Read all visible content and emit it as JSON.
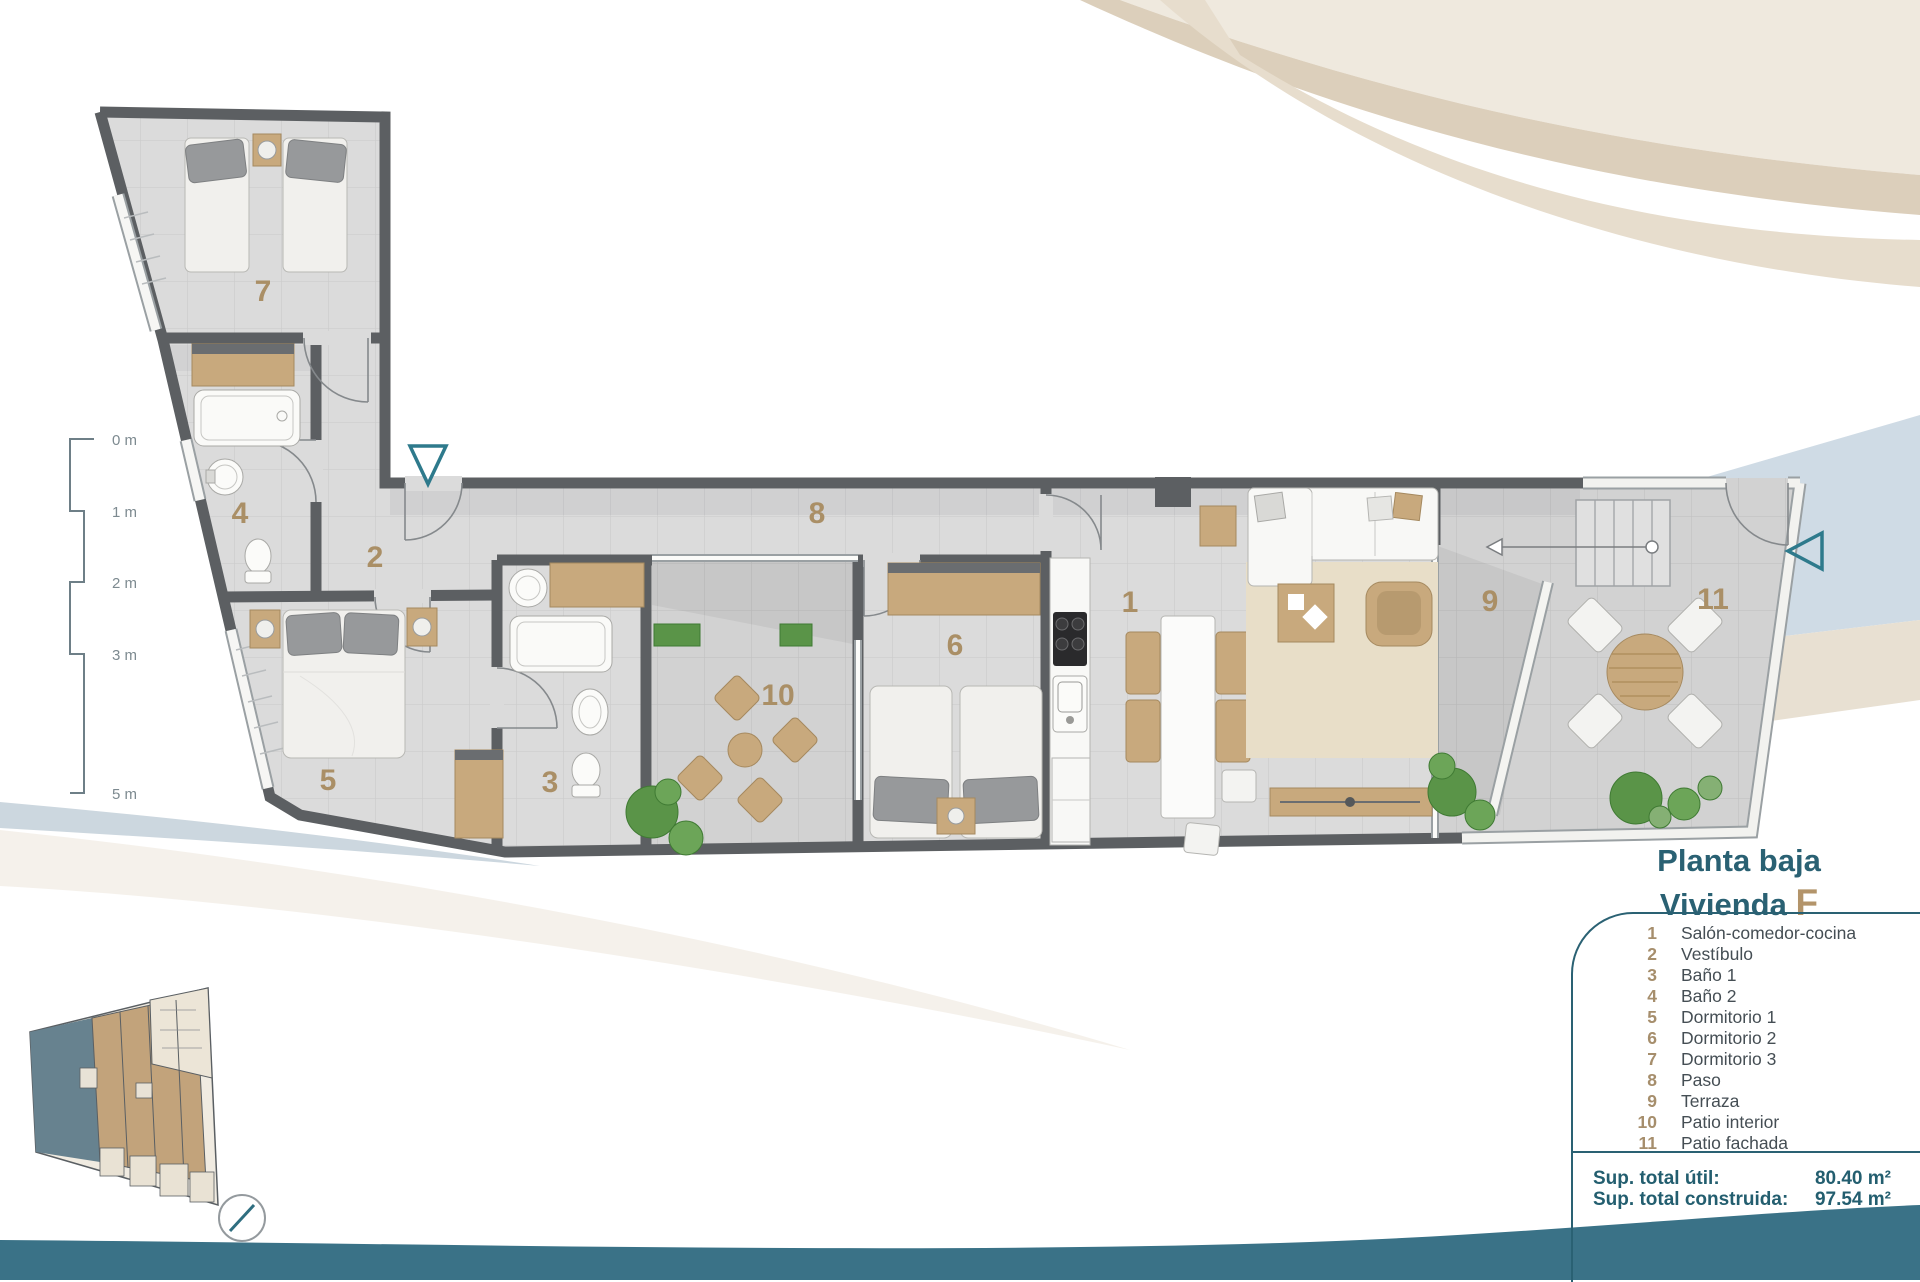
{
  "title": {
    "floor": "Planta baja",
    "dwelling_prefix": "Vivienda",
    "dwelling_letter": "F"
  },
  "legend": {
    "items": [
      {
        "num": "1",
        "label": "Salón-comedor-cocina"
      },
      {
        "num": "2",
        "label": "Vestíbulo"
      },
      {
        "num": "3",
        "label": "Baño 1"
      },
      {
        "num": "4",
        "label": "Baño 2"
      },
      {
        "num": "5",
        "label": "Dormitorio 1"
      },
      {
        "num": "6",
        "label": "Dormitorio 2"
      },
      {
        "num": "7",
        "label": "Dormitorio 3"
      },
      {
        "num": "8",
        "label": "Paso"
      },
      {
        "num": "9",
        "label": "Terraza"
      },
      {
        "num": "10",
        "label": "Patio interior"
      },
      {
        "num": "11",
        "label": "Patio fachada"
      }
    ]
  },
  "totals": {
    "util_label": "Sup. total útil:",
    "util_value": "80.40 m²",
    "built_label": "Sup. total construida:",
    "built_value": "97.54 m²"
  },
  "scale_bar": {
    "labels": [
      "0 m",
      "1 m",
      "2 m",
      "3 m",
      "5 m"
    ]
  },
  "colors": {
    "accent_teal": "#2a6173",
    "accent_tan": "#b3946a",
    "wave": "#3a7287",
    "wall": "#5c5f62"
  }
}
